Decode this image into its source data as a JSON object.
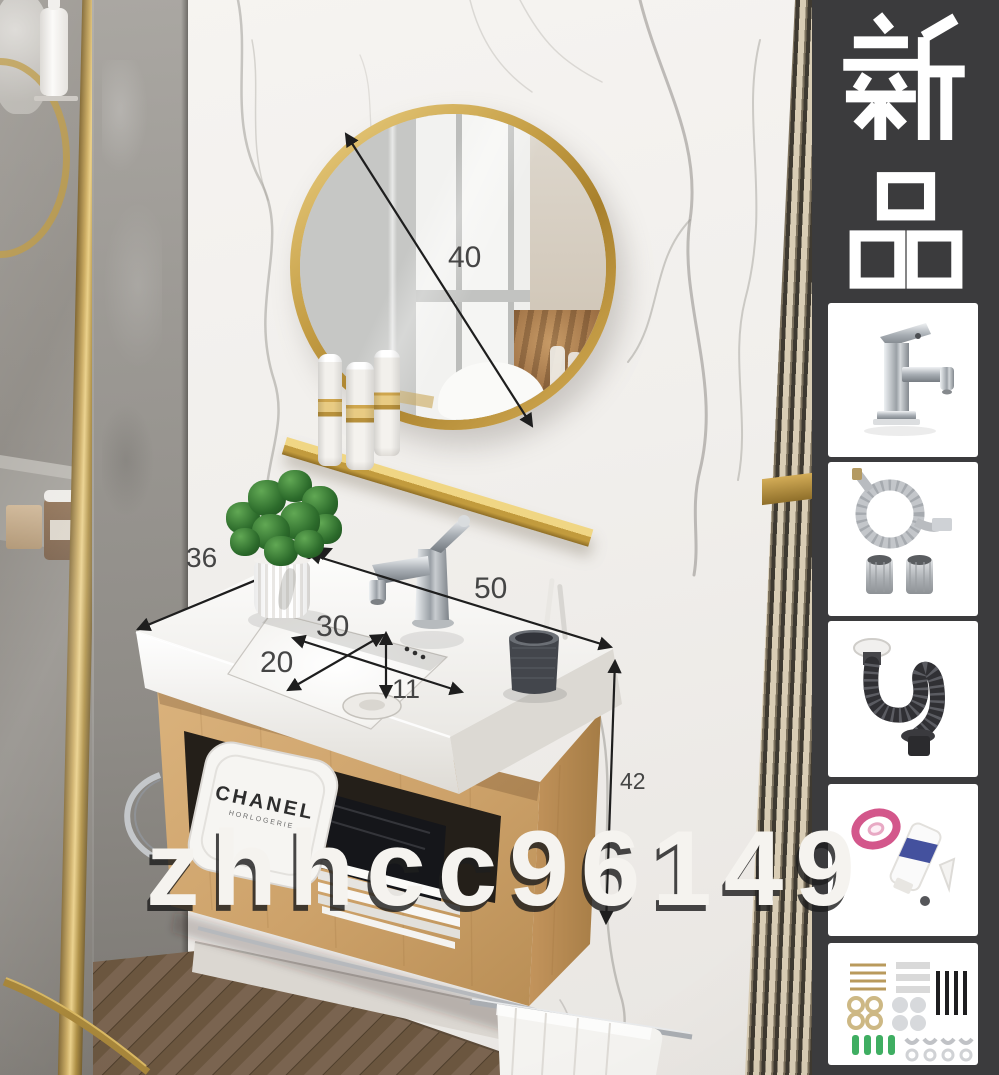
{
  "photo": {
    "watermark_text": "zhhcc96149",
    "labels": {
      "mirror_diameter": "40",
      "counter_depth": "36",
      "counter_width": "50",
      "basin_width": "30",
      "basin_depth": "20",
      "basin_inner_height": "11",
      "cabinet_height": "42"
    },
    "towel_brand": "CHANEL",
    "towel_brand_sub": "HORLOGERIE"
  },
  "sidebar": {
    "badge_text": "新品",
    "accessories": [
      {
        "name": "chrome basin faucet"
      },
      {
        "name": "braided water supply hoses with fittings"
      },
      {
        "name": "flexible pop-up drain pipe"
      },
      {
        "name": "thread seal tape and sealant tube"
      },
      {
        "name": "wall mounting hardware kit"
      }
    ]
  },
  "colors": {
    "accent_gold": "#c9a24a",
    "wood": "#c89c66",
    "sidebar_bg": "#3b3b3d",
    "marble": "#f3f1ee",
    "dimension_text": "#454545"
  }
}
